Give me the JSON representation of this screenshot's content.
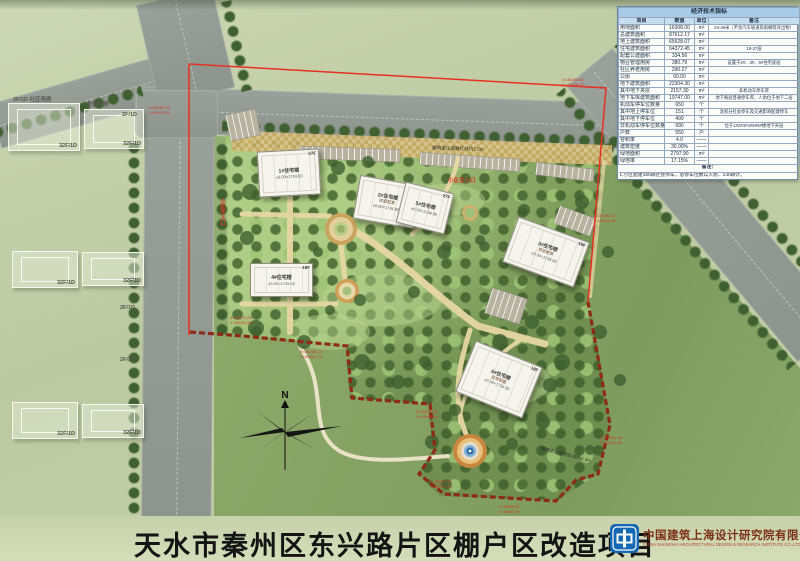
{
  "title_bar": {
    "title": "天水市秦州区东兴路片区棚户区改造项目"
  },
  "publisher": {
    "logo_cn": "中国建筑上海设计研究院有限公司",
    "logo_en": "CHINA SHANGHAI ARCHITECTURAL DESIGN & RESEARCH INSTITUTE CO.,LTD"
  },
  "compass": {
    "north_label": "N"
  },
  "indicator_table": {
    "title": "经济技术指标",
    "headers": [
      "项目",
      "数值",
      "单位",
      "备注"
    ],
    "rows": [
      [
        "用地面积",
        "16308.00",
        "m²",
        "24-49米（不含汽车坡道及雨棚等突出物）"
      ],
      [
        "总建筑面积",
        "87612.17",
        "m²",
        ""
      ],
      [
        "地上建筑面积",
        "65628.07",
        "m²",
        ""
      ],
      [
        "住宅建筑面积",
        "64372.45",
        "m²",
        "18-27层"
      ],
      [
        "配套公建面积",
        "334.56",
        "m²",
        ""
      ],
      [
        "物业管理用房",
        "380.79",
        "m²",
        "设置于2#、3#、6#住宅底层"
      ],
      [
        "社区养老用房",
        "290.27",
        "m²",
        ""
      ],
      [
        "公厕",
        "60.00",
        "m²",
        ""
      ],
      [
        "地下建筑面积",
        "22304.30",
        "m²",
        ""
      ],
      [
        "其中地下夹层",
        "2157.30",
        "m²",
        "非机动车停车库"
      ],
      [
        "地下车库建筑面积",
        "19747.00",
        "m²",
        "地下两层普通停车库，人防位于地下二层"
      ],
      [
        "机动车停车位数量",
        "650",
        "个",
        ""
      ],
      [
        "其中地上停车位",
        "151",
        "个",
        "含部分社会停车及交通影响配建停车"
      ],
      [
        "其中地下停车位",
        "499",
        "个",
        ""
      ],
      [
        "非机动车停车位数量",
        "990",
        "个",
        "位于1#2#3#4#5#6#楼地下夹层"
      ],
      [
        "户数",
        "550",
        "户",
        ""
      ],
      [
        "容积率",
        "4.0",
        "——",
        ""
      ],
      [
        "建筑密度",
        "30.00%",
        "——",
        ""
      ],
      [
        "绿地面积",
        "2797.90",
        "m²",
        ""
      ],
      [
        "绿地率",
        "17.15%",
        "——",
        ""
      ]
    ],
    "note_title": "备注：",
    "note": "1.小区配建150辆社会停车，总停车位数以人防、140辆计。"
  },
  "site": {
    "buildings": [
      {
        "name": "1#住宅楼",
        "sub": "",
        "floors": "27F",
        "elev": "±0.00=1734.50",
        "x": 258,
        "y": 150,
        "w": 62,
        "h": 46,
        "rot": -3
      },
      {
        "name": "2#住宅楼",
        "sub": "底层配套",
        "floors": "27F",
        "elev": "±0.00=1734.80",
        "x": 356,
        "y": 180,
        "w": 62,
        "h": 44,
        "rot": 10
      },
      {
        "name": "5#住宅楼",
        "sub": "",
        "floors": "27F",
        "elev": "±0.00=1734.80",
        "x": 400,
        "y": 187,
        "w": 50,
        "h": 42,
        "rot": 14
      },
      {
        "name": "3#住宅楼",
        "sub": "底层配套",
        "floors": "18F",
        "elev": "±0.00=1735.00",
        "x": 508,
        "y": 228,
        "w": 76,
        "h": 48,
        "rot": 20
      },
      {
        "name": "4#住宅楼",
        "sub": "",
        "floors": "18F",
        "elev": "±0.00=1735.05",
        "x": 250,
        "y": 263,
        "w": 63,
        "h": 34,
        "rot": 0
      },
      {
        "name": "6#住宅楼",
        "sub": "底层配套",
        "floors": "18F",
        "elev": "±0.00=1734.80",
        "x": 463,
        "y": 352,
        "w": 72,
        "h": 55,
        "rot": 22
      }
    ]
  },
  "context": {
    "buildings": [
      {
        "label": "32F/1D",
        "x": 8,
        "y": 103,
        "w": 72,
        "h": 48
      },
      {
        "label": "32F/1D",
        "x": 84,
        "y": 109,
        "w": 60,
        "h": 40
      },
      {
        "label": "32F/1D",
        "x": 12,
        "y": 251,
        "w": 66,
        "h": 37
      },
      {
        "label": "32F/1D",
        "x": 82,
        "y": 252,
        "w": 62,
        "h": 34
      },
      {
        "label": "32F/1D",
        "x": 12,
        "y": 402,
        "w": 66,
        "h": 37
      },
      {
        "label": "32F/1D",
        "x": 82,
        "y": 404,
        "w": 62,
        "h": 34
      }
    ],
    "tags": [
      {
        "t": "2F/1D 社区用房",
        "x": 13,
        "y": 95
      },
      {
        "t": "配套用房",
        "x": 87,
        "y": 100
      },
      {
        "t": "2F/1D",
        "x": 122,
        "y": 112
      },
      {
        "t": "2F/1D",
        "x": 120,
        "y": 305
      },
      {
        "t": "2F/1D",
        "x": 120,
        "y": 357
      }
    ]
  },
  "annotations": {
    "entrances": [
      {
        "text": "小区主入口",
        "x": 448,
        "y": 176,
        "vert": false
      },
      {
        "text": "小区次入口",
        "x": 218,
        "y": 198,
        "vert": true
      }
    ],
    "setbacks": [
      {
        "text": "建筑退让道路红线约7.5m",
        "x": 432,
        "y": 146,
        "rot": 2
      },
      {
        "text": "建筑退让用地红线约6.3m",
        "x": 540,
        "y": 452,
        "rot": 14
      }
    ],
    "coords": [
      {
        "x": 148,
        "y": 106,
        "l1": "X=38290.15",
        "l2": "Y=49021.06"
      },
      {
        "x": 562,
        "y": 78,
        "l1": "X=38293.40",
        "l2": "Y=49106.25"
      },
      {
        "x": 594,
        "y": 214,
        "l1": "X=38285.12",
        "l2": "Y=49121.30"
      },
      {
        "x": 230,
        "y": 316,
        "l1": "X=38271.26",
        "l2": "Y=49022.85"
      },
      {
        "x": 300,
        "y": 350,
        "l1": "X=38268.10",
        "l2": "Y=49041.72"
      },
      {
        "x": 416,
        "y": 410,
        "l1": "X=38262.35",
        "l2": "Y=49065.18"
      },
      {
        "x": 430,
        "y": 480,
        "l1": "X=38257.44",
        "l2": "Y=49071.90"
      },
      {
        "x": 498,
        "y": 505,
        "l1": "X=38255.61",
        "l2": "Y=49087.33"
      },
      {
        "x": 600,
        "y": 436,
        "l1": "X=38261.08",
        "l2": "Y=49112.46"
      }
    ]
  },
  "colors": {
    "boundary_solid": "#e53122",
    "boundary_dashed": "#8d2b18",
    "road": "#8f948f",
    "accent_red": "#d03322",
    "table_header_bg": "#c6ddf2",
    "logo_blue": "#1467b2"
  }
}
